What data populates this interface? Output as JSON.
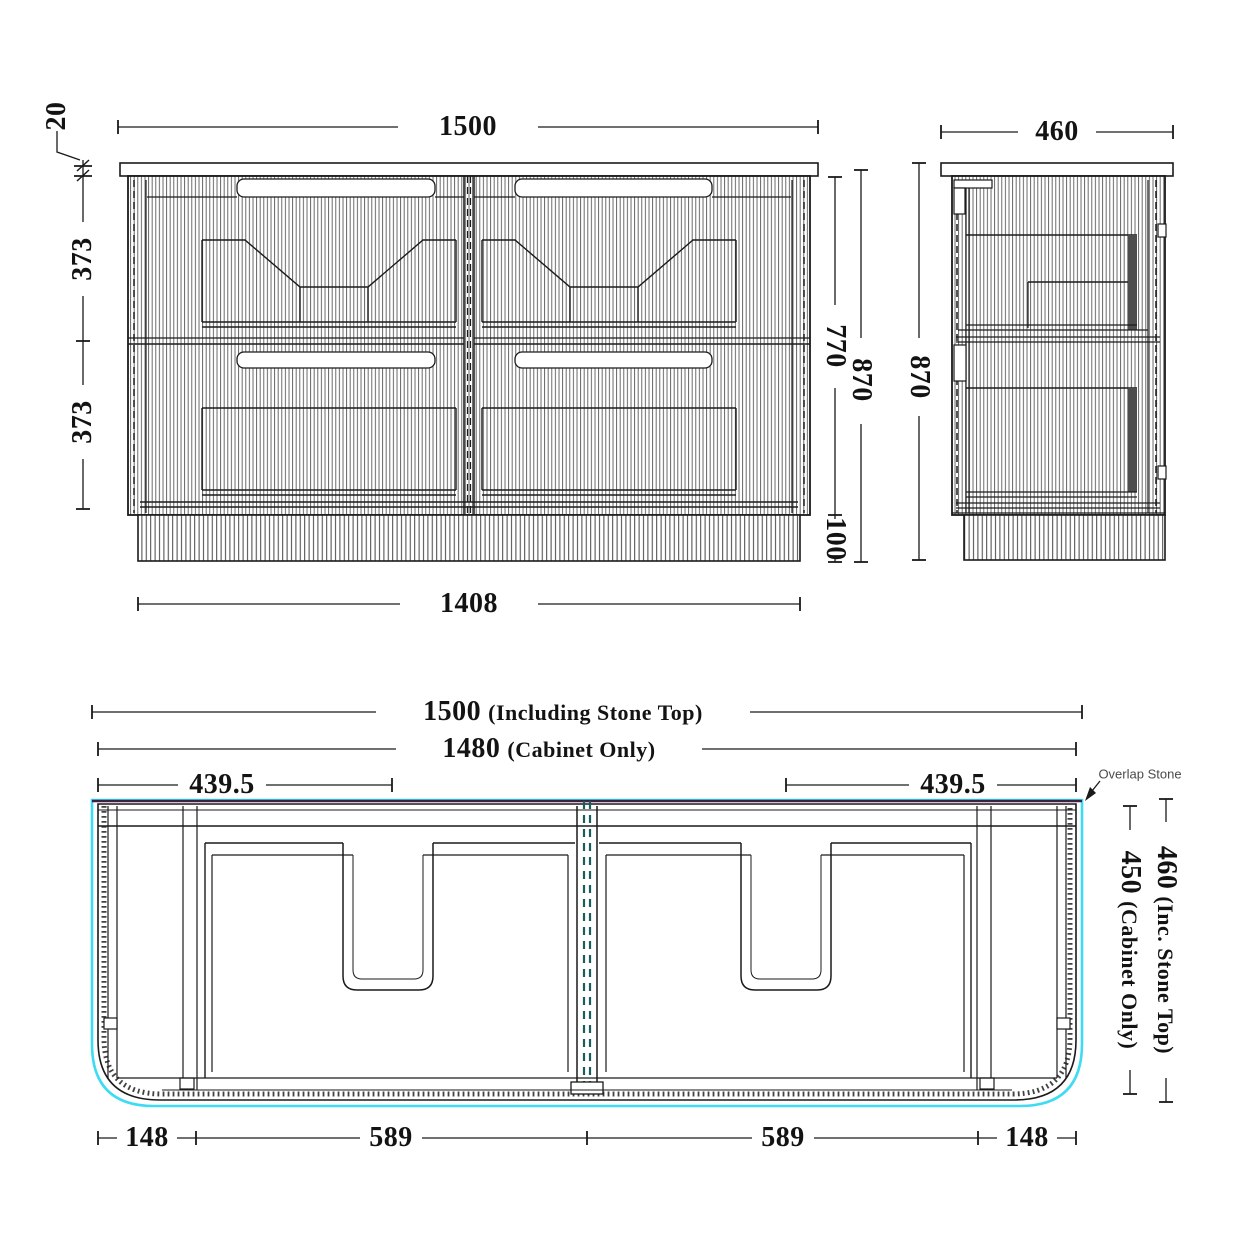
{
  "drawing": {
    "title": "Vanity cabinet technical drawing",
    "front_view": {
      "overall_width": "1500",
      "stone_thickness": "20",
      "upper_drawer_height": "373",
      "lower_drawer_height": "373",
      "kickboard_width": "1408",
      "cabinet_body_height": "770",
      "overall_height": "870",
      "kickboard_height": "100"
    },
    "side_view": {
      "overall_depth": "460",
      "overall_height": "870"
    },
    "plan_view": {
      "overall_width_value": "1500",
      "overall_width_note": "(Including Stone Top)",
      "cabinet_width_value": "1480",
      "cabinet_width_note": "(Cabinet Only)",
      "basin_centre_left": "439.5",
      "basin_centre_right": "439.5",
      "front_seg_1": "148",
      "front_seg_2": "589",
      "front_seg_3": "589",
      "front_seg_4": "148",
      "depth_cabinet_value": "450",
      "depth_cabinet_note": "(Cabinet Only)",
      "depth_total_value": "460",
      "depth_total_note": "(Inc. Stone Top)",
      "overlap_stone_label": "Overlap Stone"
    },
    "colors": {
      "line": "#1a1a1a",
      "stone_edge_cyan": "#3edcf4",
      "partition_dash_teal": "#1d5c5c",
      "back_edge_purple": "#402040"
    }
  }
}
